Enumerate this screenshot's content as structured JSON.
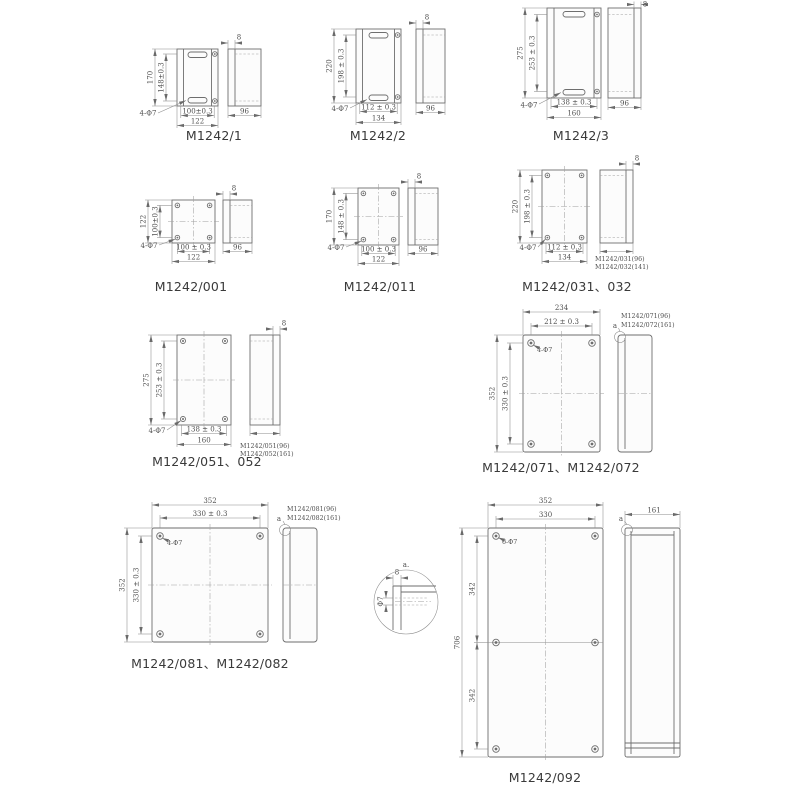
{
  "colors": {
    "background": "#ffffff",
    "object_line": "#6e6e6e",
    "dim_line": "#8b8b8b",
    "dim_text": "#4f4f4f",
    "title_text": "#3a3a3a"
  },
  "drawings": {
    "m1242_1": {
      "title": "M1242/1",
      "height": "170",
      "inner_height": "148±0.3",
      "inner_width": "100±0.3",
      "width": "122",
      "holes": "4-Φ7",
      "depth": "96",
      "lid": "8"
    },
    "m1242_2": {
      "title": "M1242/2",
      "height": "220",
      "inner_height": "198 ± 0.3",
      "inner_width": "112 ± 0.3",
      "width": "134",
      "holes": "4-Φ7",
      "depth": "96",
      "lid": "8"
    },
    "m1242_3": {
      "title": "M1242/3",
      "height": "275",
      "inner_height": "253 ± 0.3",
      "inner_width": "138 ± 0.3",
      "width": "160",
      "holes": "4-Φ7",
      "depth": "96",
      "lid": "8"
    },
    "m1242_001": {
      "title": "M1242/001",
      "height": "122",
      "inner_height": "100±0.3",
      "inner_width": "100 ± 0.3",
      "width": "122",
      "holes": "4-Φ7",
      "depth": "96",
      "lid": "8"
    },
    "m1242_011": {
      "title": "M1242/011",
      "height": "170",
      "inner_height": "148 ± 0.3",
      "inner_width": "100 ± 0.3",
      "width": "122",
      "holes": "4-Φ7",
      "depth": "96",
      "lid": "8"
    },
    "m1242_031": {
      "title": "M1242/031、032",
      "height": "220",
      "inner_height": "198 ± 0.3",
      "inner_width": "112 ± 0.3",
      "width": "134",
      "holes": "4-Φ7",
      "lid": "8",
      "variant1": "M1242/031(96)",
      "variant2": "M1242/032(141)"
    },
    "m1242_051": {
      "title": "M1242/051、052",
      "height": "275",
      "inner_height": "253 ± 0.3",
      "inner_width": "138 ± 0.3",
      "width": "160",
      "holes": "4-Φ7",
      "lid": "8",
      "variant1": "M1242/051(96)",
      "variant2": "M1242/052(161)"
    },
    "m1242_071": {
      "title": "M1242/071、M1242/072",
      "width": "234",
      "inner_width": "212 ± 0.3",
      "height": "352",
      "inner_height": "330 ± 0.3",
      "holes": "4-Φ7",
      "marker": "a",
      "variant1": "M1242/071(96)",
      "variant2": "M1242/072(161)"
    },
    "m1242_081": {
      "title": "M1242/081、M1242/082",
      "width": "352",
      "inner_width": "330 ± 0.3",
      "height": "352",
      "inner_height": "330 ± 0.3",
      "holes": "4-Φ7",
      "marker": "a",
      "variant1": "M1242/081(96)",
      "variant2": "M1242/082(161)"
    },
    "m1242_092": {
      "title": "M1242/092",
      "width": "352",
      "inner_width": "330",
      "height": "706",
      "segment_top": "342",
      "segment_bottom": "342",
      "holes": "6-Φ7",
      "marker": "a",
      "depth": "161"
    },
    "detail_a": {
      "label": "a.",
      "lip": "8",
      "hole": "Φ7"
    }
  }
}
